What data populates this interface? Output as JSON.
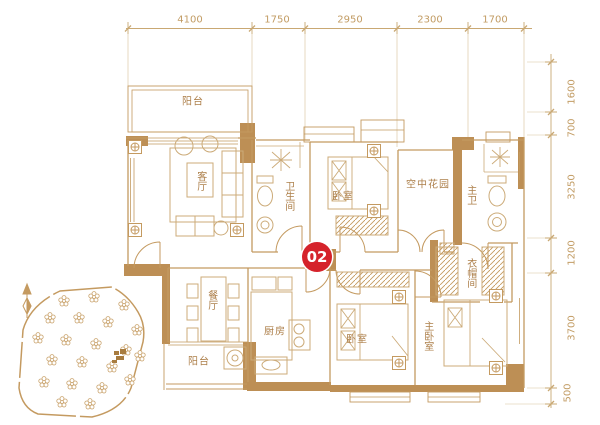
{
  "unit_badge": "02",
  "rooms": {
    "balcony_top": "阳台",
    "living_room": "客厅",
    "bathroom": "卫生间",
    "bedroom_top": "卧室",
    "sky_garden": "空中花园",
    "master_bath": "主卫",
    "dining_room": "餐厅",
    "kitchen": "厨房",
    "balcony_bottom": "阳台",
    "bedroom_bottom": "卧室",
    "master_bedroom": "主卧室",
    "cloakroom": "衣帽间"
  },
  "dimensions": {
    "top": [
      "4100",
      "1750",
      "2950",
      "2300",
      "1700"
    ],
    "right": [
      "1600",
      "700",
      "3250",
      "1200",
      "3700",
      "500"
    ]
  },
  "colors": {
    "plan_line": "#c49a60",
    "wall_fill": "#bd8f55",
    "furniture_line": "#ccab79",
    "label_text": "#ad7f4a",
    "dimension_text": "#c29c64",
    "badge_background": "#d5232b",
    "badge_text": "#ffffff"
  }
}
